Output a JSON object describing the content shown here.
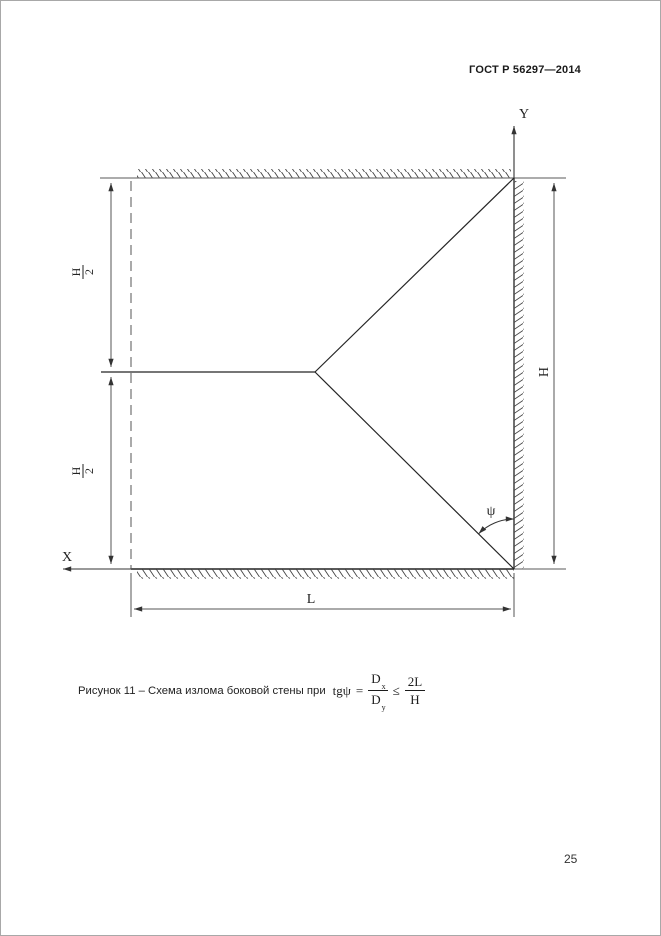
{
  "page": {
    "header_title": "ГОСТ Р 56297—2014",
    "page_number": "25"
  },
  "diagram": {
    "axis_y_label": "Y",
    "axis_x_label": "X",
    "dim_upper_left_numerator": "H",
    "dim_upper_left_denominator": "2",
    "dim_lower_left_numerator": "H",
    "dim_lower_left_denominator": "2",
    "dim_right_height_label": "H",
    "dim_bottom_length_label": "L",
    "angle_label": "ψ"
  },
  "caption": {
    "text": "Рисунок 11 – Схема излома боковой стены при",
    "formula": {
      "lhs": "tgψ",
      "eq": "=",
      "num1": "D",
      "num1_sub": "x",
      "den1": "D",
      "den1_sub": "y",
      "rel": "≤",
      "num2": "2L",
      "den2": "H"
    }
  },
  "colors": {
    "line_main": "#2b2b2b",
    "line_dim": "#555555",
    "hatch": "#444444",
    "page_border": "#a8a8a8"
  }
}
